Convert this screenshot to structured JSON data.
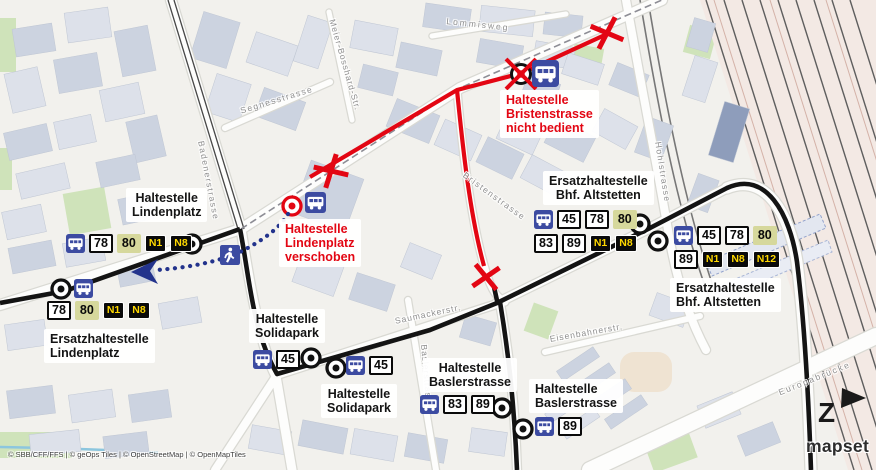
{
  "map": {
    "attribution": "© SBB/CFF/FFS | © geOps Tiles | © OpenStreetMap | © OpenMapTiles",
    "logo": "mapset",
    "north_label": "Z",
    "colors": {
      "closure_red": "#e30613",
      "route_black": "#141414",
      "walk_blue": "#23338c",
      "bus_icon_blue": "#3c4ba1",
      "badge_olive": "#d6d89c",
      "night_yellow": "#ffd800"
    }
  },
  "stop_labels": [
    {
      "name": "label-haltestelle-lindenplatz",
      "lines": [
        "Haltestelle",
        "Lindenplatz"
      ],
      "color": "black",
      "align": "center",
      "x": 126,
      "y": 188
    },
    {
      "name": "label-ersatzhaltestelle-lindenplatz",
      "lines": [
        "Ersatzhaltestelle",
        "Lindenplatz"
      ],
      "color": "black",
      "align": "left",
      "x": 44,
      "y": 329
    },
    {
      "name": "label-haltestelle-solidapark-1",
      "lines": [
        "Haltestelle",
        "Solidapark"
      ],
      "color": "black",
      "align": "center",
      "x": 249,
      "y": 309
    },
    {
      "name": "label-haltestelle-solidapark-2",
      "lines": [
        "Haltestelle",
        "Solidapark"
      ],
      "color": "black",
      "align": "center",
      "x": 321,
      "y": 384
    },
    {
      "name": "label-haltestelle-baslerstrasse-1",
      "lines": [
        "Haltestelle",
        "Baslerstrasse"
      ],
      "color": "black",
      "align": "center",
      "x": 423,
      "y": 358
    },
    {
      "name": "label-haltestelle-baslerstrasse-2",
      "lines": [
        "Haltestelle",
        "Baslerstrasse"
      ],
      "color": "black",
      "align": "left",
      "x": 529,
      "y": 379
    },
    {
      "name": "label-ersatzhaltestelle-bhf-altstetten-1",
      "lines": [
        "Ersatzhaltestelle",
        "Bhf. Altstetten"
      ],
      "color": "black",
      "align": "center",
      "x": 543,
      "y": 171
    },
    {
      "name": "label-ersatzhaltestelle-bhf-altstetten-2",
      "lines": [
        "Ersatzhaltestelle",
        "Bhf. Altstetten"
      ],
      "color": "black",
      "align": "left",
      "x": 670,
      "y": 278
    },
    {
      "name": "notice-lindenplatz-verschoben",
      "lines": [
        "Haltestelle",
        "Lindenplatz",
        "verschoben"
      ],
      "color": "red",
      "align": "left",
      "x": 279,
      "y": 219
    },
    {
      "name": "notice-bristenstrasse-nicht-bedient",
      "lines": [
        "Haltestelle",
        "Bristenstrasse",
        "nicht bedient"
      ],
      "color": "red",
      "align": "left",
      "x": 500,
      "y": 90
    }
  ],
  "street_labels": [
    {
      "text": "Lommisweg",
      "x": 447,
      "y": 16,
      "rot": 6,
      "ls": 2
    },
    {
      "text": "Meier-Bosshard-Str.",
      "x": 337,
      "y": 18,
      "rot": 74,
      "ls": 1
    },
    {
      "text": "Segnesstrasse",
      "x": 239,
      "y": 106,
      "rot": -17,
      "ls": 1.5
    },
    {
      "text": "Badenerstrasse",
      "x": 206,
      "y": 140,
      "rot": 79,
      "ls": 1.5
    },
    {
      "text": "Bristenstrasse",
      "x": 467,
      "y": 170,
      "rot": 36,
      "ls": 1.5
    },
    {
      "text": "Saumackerstr.",
      "x": 394,
      "y": 316,
      "rot": -12,
      "ls": 1
    },
    {
      "text": "Baslerstrasse",
      "x": 429,
      "y": 344,
      "rot": 85,
      "ls": 1
    },
    {
      "text": "Hohlstrasse",
      "x": 663,
      "y": 141,
      "rot": 81,
      "ls": 1.5
    },
    {
      "text": "Eisenbahnerstr.",
      "x": 549,
      "y": 334,
      "rot": -10,
      "ls": 1
    },
    {
      "text": "Europabrücke",
      "x": 777,
      "y": 388,
      "rot": -22,
      "ls": 2
    }
  ],
  "badge_groups": [
    {
      "name": "stop-group-lindenplatz",
      "x": 66,
      "y": 234,
      "items": [
        {
          "k": "bus"
        },
        {
          "t": "78",
          "s": "w"
        },
        {
          "t": "80",
          "s": "o"
        },
        {
          "t": "N1",
          "s": "n"
        },
        {
          "t": "N8",
          "s": "n"
        }
      ]
    },
    {
      "name": "stop-group-ersatz-lindenplatz-icon",
      "x": 74,
      "y": 279,
      "items": [
        {
          "k": "bus"
        }
      ]
    },
    {
      "name": "stop-group-ersatz-lindenplatz",
      "x": 47,
      "y": 301,
      "items": [
        {
          "t": "78",
          "s": "w"
        },
        {
          "t": "80",
          "s": "o"
        },
        {
          "t": "N1",
          "s": "n"
        },
        {
          "t": "N8",
          "s": "n"
        }
      ]
    },
    {
      "name": "stop-group-solidapark-1",
      "x": 253,
      "y": 350,
      "items": [
        {
          "k": "bus"
        },
        {
          "t": "45",
          "s": "w"
        }
      ]
    },
    {
      "name": "stop-group-solidapark-2",
      "x": 346,
      "y": 356,
      "items": [
        {
          "k": "bus"
        },
        {
          "t": "45",
          "s": "w"
        }
      ]
    },
    {
      "name": "stop-group-baslerstrasse-1",
      "x": 420,
      "y": 395,
      "items": [
        {
          "k": "bus"
        },
        {
          "t": "83",
          "s": "w"
        },
        {
          "t": "89",
          "s": "w"
        }
      ]
    },
    {
      "name": "stop-group-baslerstrasse-2",
      "x": 535,
      "y": 417,
      "items": [
        {
          "k": "bus"
        },
        {
          "t": "89",
          "s": "w"
        }
      ]
    },
    {
      "name": "stop-group-bhf-altstetten-1a",
      "x": 534,
      "y": 210,
      "items": [
        {
          "k": "bus"
        },
        {
          "t": "45",
          "s": "w"
        },
        {
          "t": "78",
          "s": "w"
        },
        {
          "t": "80",
          "s": "o"
        }
      ]
    },
    {
      "name": "stop-group-bhf-altstetten-1b",
      "x": 534,
      "y": 234,
      "items": [
        {
          "t": "83",
          "s": "w"
        },
        {
          "t": "89",
          "s": "w"
        },
        {
          "t": "N1",
          "s": "n"
        },
        {
          "t": "N8",
          "s": "n"
        }
      ]
    },
    {
      "name": "stop-group-bhf-altstetten-2a",
      "x": 674,
      "y": 226,
      "items": [
        {
          "k": "bus"
        },
        {
          "t": "45",
          "s": "w"
        },
        {
          "t": "78",
          "s": "w"
        },
        {
          "t": "80",
          "s": "o"
        }
      ]
    },
    {
      "name": "stop-group-bhf-altstetten-2b",
      "x": 674,
      "y": 250,
      "items": [
        {
          "t": "89",
          "s": "w"
        },
        {
          "t": "N1",
          "s": "n"
        },
        {
          "t": "N8",
          "s": "n"
        },
        {
          "t": "N12",
          "s": "n"
        }
      ]
    },
    {
      "name": "relocated-stop-icon",
      "x": 305,
      "y": 192,
      "size": 21,
      "items": [
        {
          "k": "bus"
        }
      ]
    },
    {
      "name": "closed-stop-icon-bristenstrasse",
      "x": 532,
      "y": 60,
      "size": 27,
      "items": [
        {
          "k": "bus"
        }
      ]
    }
  ]
}
